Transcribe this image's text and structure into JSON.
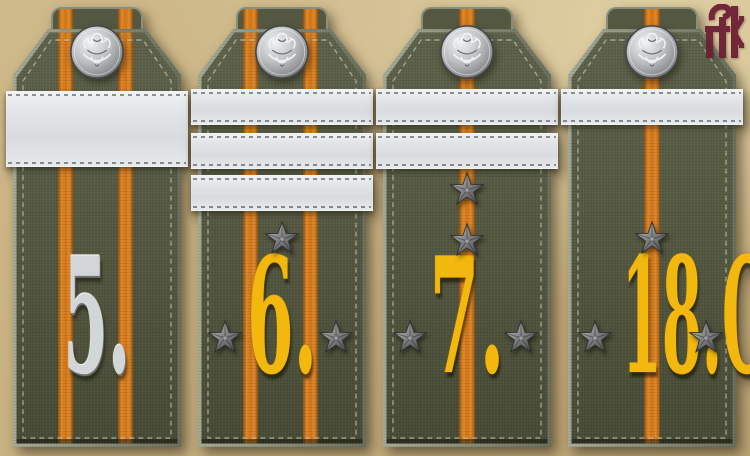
{
  "scene": {
    "subject": "four military shoulder boards",
    "background_color": "#c8b181"
  },
  "straps": [
    {
      "numeral": "5.",
      "numeral_finish": "silver",
      "stripe_count": 2,
      "band_style": "one-wide",
      "bands": [
        "wide"
      ],
      "stars": []
    },
    {
      "numeral": "6.",
      "numeral_finish": "gold",
      "stripe_count": 2,
      "band_style": "three-narrow",
      "bands": [
        "narrow",
        "narrow",
        "narrow"
      ],
      "stars": [
        "above",
        "left",
        "right"
      ]
    },
    {
      "numeral": "7.",
      "numeral_finish": "gold",
      "stripe_count": 1,
      "band_style": "two-narrow",
      "bands": [
        "narrow",
        "narrow"
      ],
      "stars": [
        "above-upper",
        "above-lower",
        "left",
        "right"
      ]
    },
    {
      "numeral": "18.O.",
      "numeral_finish": "gold",
      "stripe_count": 1,
      "band_style": "one-narrow",
      "bands": [
        "narrow"
      ],
      "stars": [
        "above",
        "left",
        "right"
      ]
    }
  ],
  "logo": {
    "monogram": "ЭК",
    "color": "#6b2034"
  },
  "colors": {
    "background_tan": "#c8b181",
    "strap_green": "#545840",
    "strap_edge_gray": "#8a8f7c",
    "stripe_orange": "#d0731a",
    "band_white": "#e3e6e8",
    "stitch_khaki": "#c2c8b2",
    "star_pewter": "#7c7e80",
    "button_silver": "#bfc1c3",
    "numeral_gold": "#f2b80e",
    "numeral_silver": "#d3d6d8",
    "logo_maroon": "#6b2034"
  }
}
